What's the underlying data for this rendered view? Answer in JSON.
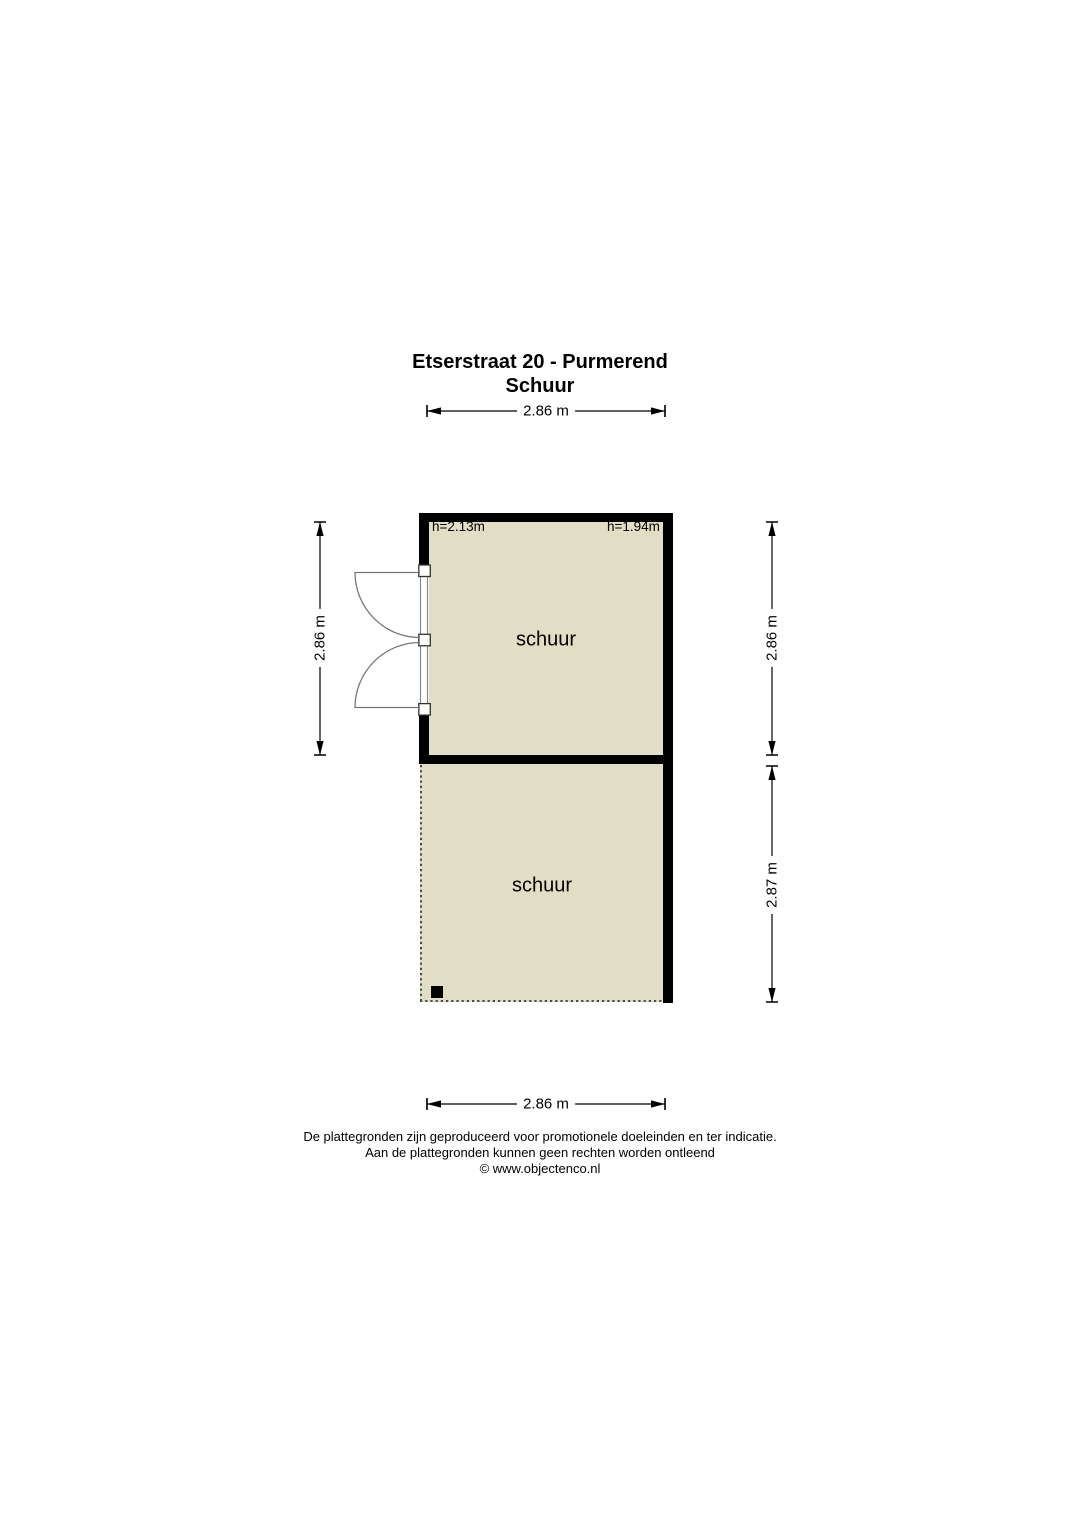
{
  "page": {
    "title": "Etserstraat 20 - Purmerend",
    "subtitle": "Schuur"
  },
  "rooms": {
    "upper": {
      "label": "schuur",
      "ceiling_height_left": "h=2.13m",
      "ceiling_height_right": "h=1.94m"
    },
    "lower": {
      "label": "schuur"
    }
  },
  "dimensions": {
    "top_width": "2.86 m",
    "left_height": "2.86 m",
    "right_upper_height": "2.86 m",
    "right_lower_height": "2.87 m",
    "bottom_width": "2.86 m"
  },
  "footer": {
    "line1": "De plattegronden zijn geproduceerd voor promotionele doeleinden en ter indicatie.",
    "line2": "Aan de plattegronden kunnen geen rechten worden ontleend",
    "line3": "© www.objectenco.nl"
  },
  "colors": {
    "floor_fill": "#e2ddc5",
    "wall": "#000000",
    "background": "#ffffff"
  }
}
